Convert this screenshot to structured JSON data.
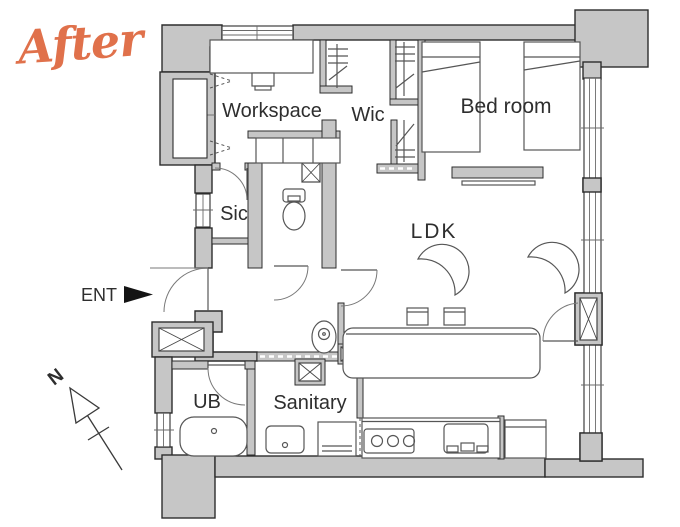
{
  "title": {
    "label": "After",
    "color": "#e0714b"
  },
  "annotations": {
    "entrance": "ENT",
    "compass_north": "N"
  },
  "rooms": {
    "workspace": {
      "label": "Workspace"
    },
    "wic": {
      "label": "Wic"
    },
    "bedroom": {
      "label": "Bed room"
    },
    "sic": {
      "label": "Sic"
    },
    "ldk": {
      "label": "LDK"
    },
    "ub": {
      "label": "UB"
    },
    "sanitary": {
      "label": "Sanitary"
    }
  },
  "palette": {
    "wall_fill": "#c6c6c6",
    "wall_outline": "#2d2d2d",
    "fixture_line": "#565656",
    "label_color": "#2e2e2e",
    "accent": "#e0714b"
  },
  "fixtures": [
    "desk",
    "desk-chair",
    "closet-hanger-pipe",
    "twin-bed",
    "tv-board",
    "lounge-chair",
    "counter-stool",
    "dining-counter",
    "washing-machine",
    "toilet",
    "storage-cabinet",
    "pipe-shaft",
    "meter-box",
    "bathtub",
    "washbasin",
    "laundry-pan",
    "gas-stove",
    "kitchen-sink",
    "refrigerator",
    "window",
    "door-swing",
    "entrance-arrow",
    "north-arrow"
  ]
}
